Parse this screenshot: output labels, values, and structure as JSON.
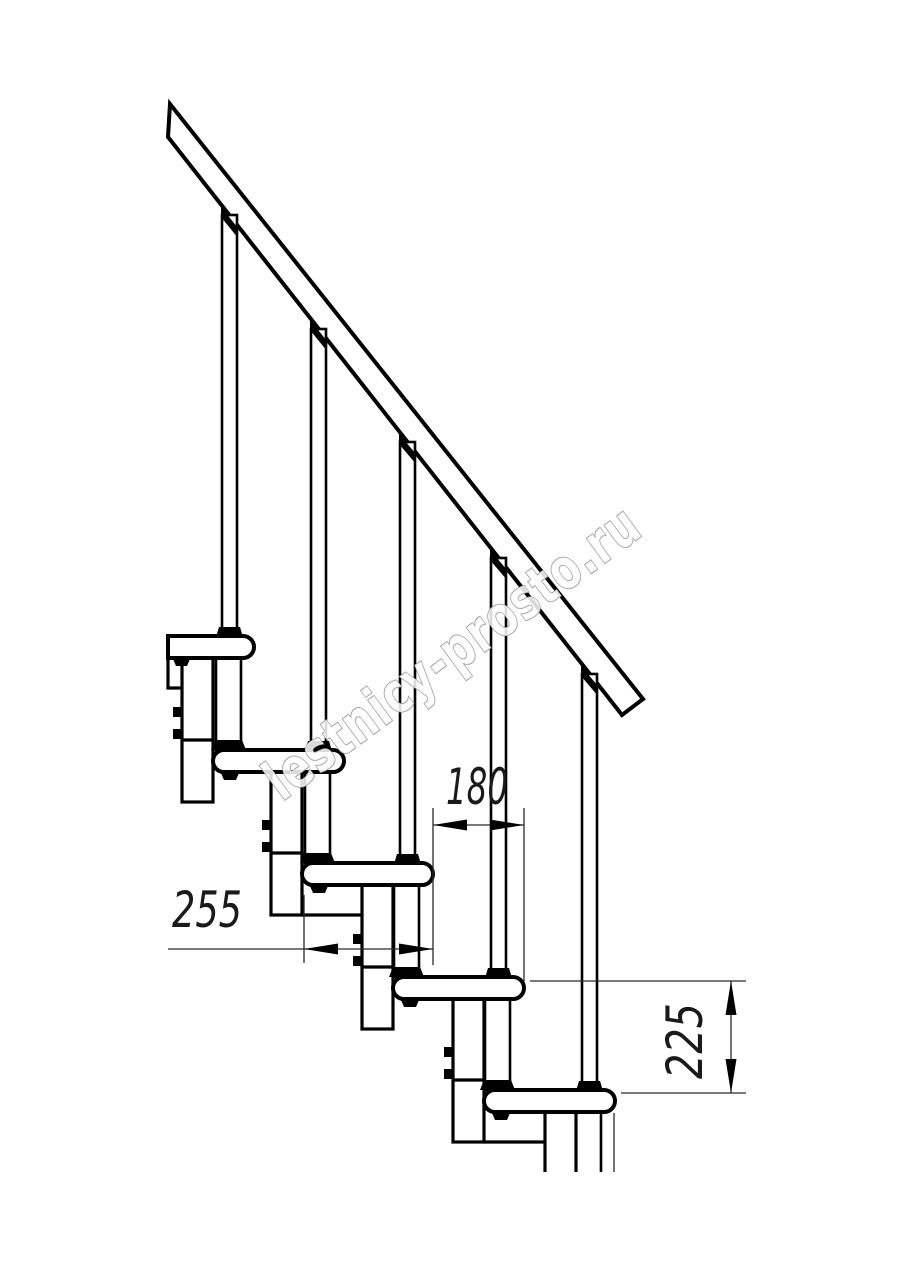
{
  "page": {
    "background_color": "#ffffff",
    "line_color": "#000000",
    "thin_line_color": "#2a2a2a"
  },
  "drawing": {
    "type": "modular-staircase-side-view",
    "steps_visible": 5,
    "balusters_visible": 5,
    "handrail_present": true,
    "watermark": {
      "text": "lestnicy-prosto.ru",
      "fill_color": "#ffffff",
      "outline_color": "#9b9b9b",
      "rotation_deg": -36.5
    },
    "dimensions": [
      {
        "id": "tread-depth",
        "label": "255",
        "orientation": "horizontal"
      },
      {
        "id": "step-run",
        "label": "180",
        "orientation": "horizontal"
      },
      {
        "id": "step-rise",
        "label": "225",
        "orientation": "vertical"
      }
    ]
  }
}
